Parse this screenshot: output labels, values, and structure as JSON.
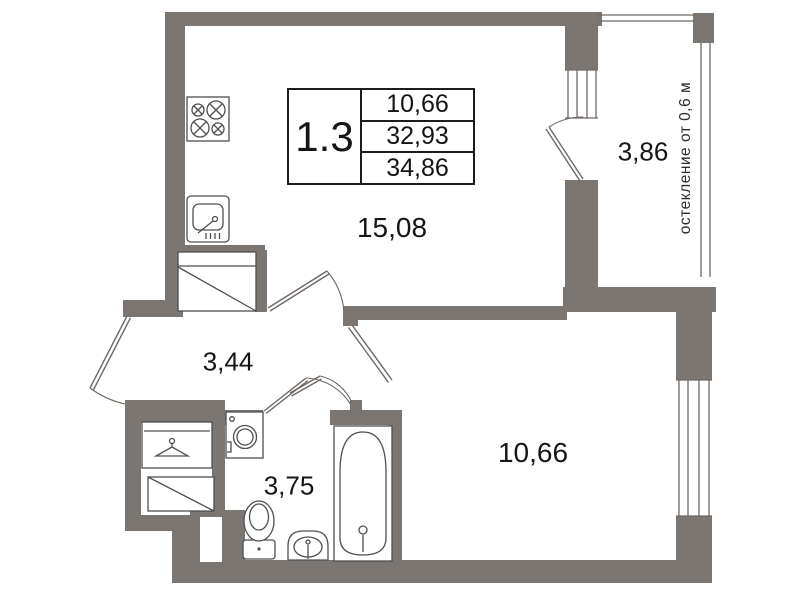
{
  "unit": {
    "number": "1.3",
    "living_area": "10,66",
    "area_without_balcony": "32,93",
    "total_area": "34,86"
  },
  "rooms": {
    "living_kitchen": "15,08",
    "balcony": "3,86",
    "hall": "3,44",
    "bathroom": "3,75",
    "bedroom": "10,66"
  },
  "notes": {
    "glazing": "остекление от 0,6 м"
  },
  "colors": {
    "wall": "#7c7672",
    "fixture_line": "#4f4f4f",
    "text": "#151515"
  },
  "icons": [
    "stove-icon",
    "kitchen-sink-icon",
    "washing-machine-icon",
    "wardrobe-hanger-icon",
    "shaft-diagonal-icon",
    "duct-diagonal-icon",
    "toilet-icon",
    "washbasin-icon",
    "bathtub-icon"
  ]
}
